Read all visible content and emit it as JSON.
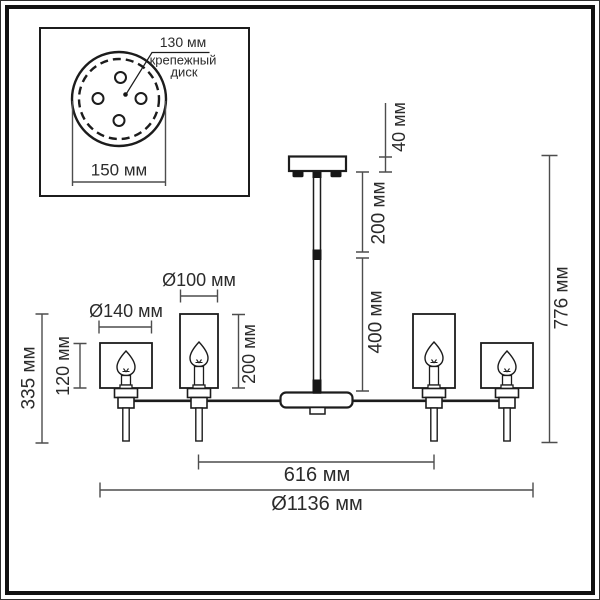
{
  "inset": {
    "bolt_circle_dim": "130 мм",
    "disk_label_line1": "крепежный",
    "disk_label_line2": "диск",
    "disk_diameter": "150 мм"
  },
  "dims": {
    "canopy_height": "40 мм",
    "upper_rod_length": "200 мм",
    "lower_rod_length": "400 мм",
    "total_height": "776 мм",
    "small_shade_diameter": "Ø100 мм",
    "large_shade_diameter": "Ø140 мм",
    "small_shade_height": "200 мм",
    "large_shade_height": "120 мм",
    "lamp_drop_height": "335 мм",
    "inner_arm_span": "616 мм",
    "overall_diameter": "Ø1136 мм"
  },
  "colors": {
    "background": "#ffffff",
    "drawing_line": "#1c1c1c",
    "dimension_line": "#4d4d4d",
    "text": "#2b2b2b",
    "frame": "#111111"
  }
}
